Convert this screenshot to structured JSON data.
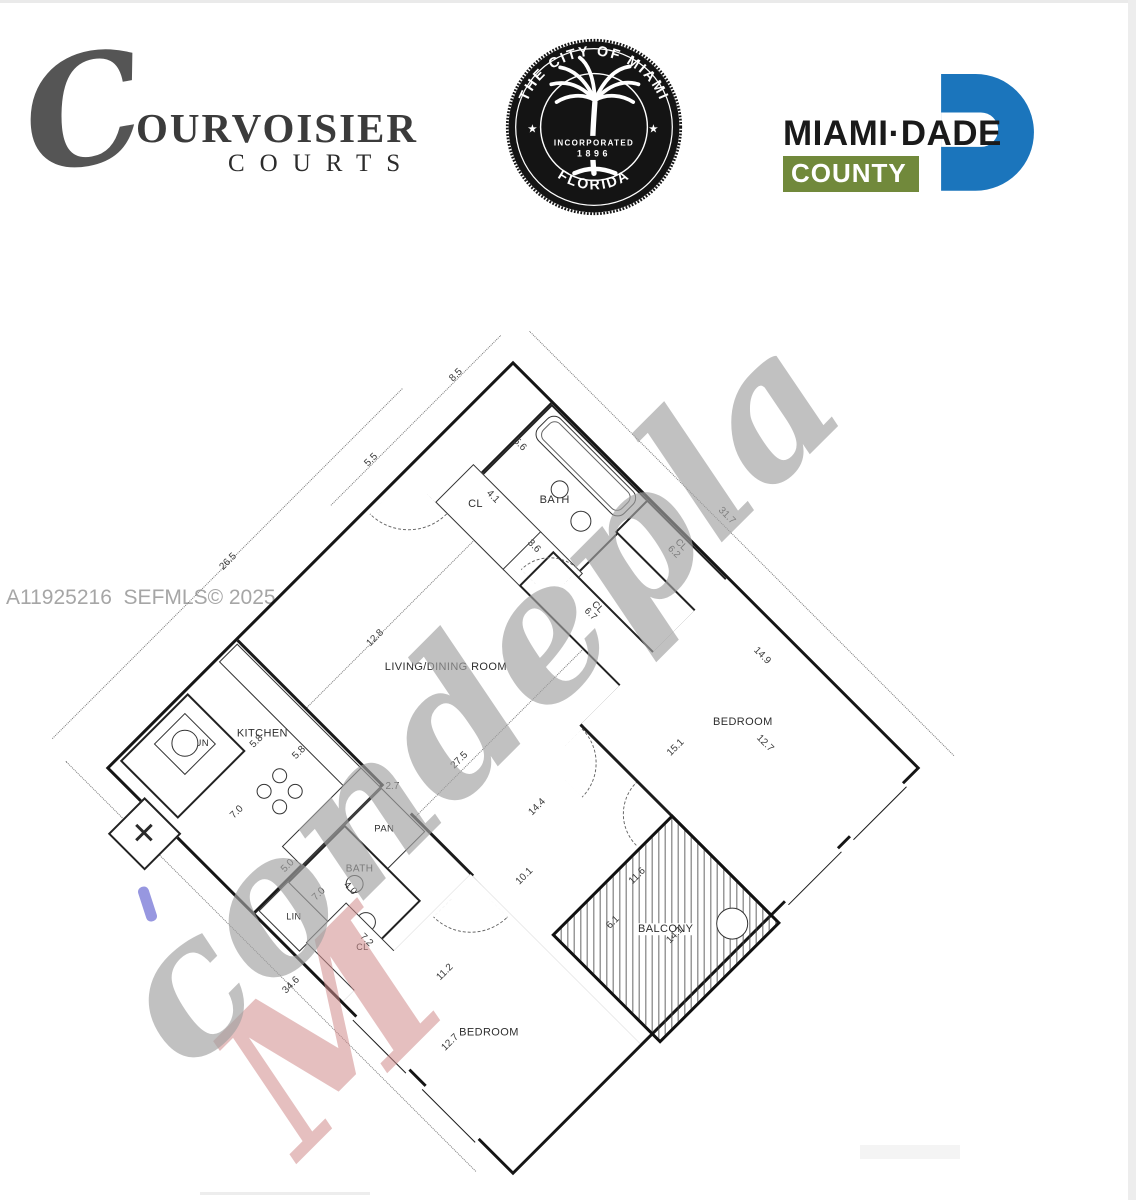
{
  "header": {
    "courvoisier": {
      "initial": "C",
      "name": "OURVOISIER",
      "sub": "COURTS"
    },
    "seal": {
      "arc_top": "THE CITY OF MIAMI",
      "arc_bottom": "FLORIDA",
      "inc1": "INCORPORATED",
      "inc2": "1896",
      "star": "★"
    },
    "dade": {
      "name": "MIAMI·DADE",
      "county": "COUNTY",
      "blue": "#1b75bc",
      "green": "#71893b"
    }
  },
  "watermark": {
    "mls": "A11925216  SEFMLS© 2025",
    "script": "condepla",
    "accent": "M",
    "script_color": "#a2a2a2",
    "accent_color": "#d08c8c"
  },
  "floorplan": {
    "shaft_mark": "✕",
    "rooms": {
      "bath1": "BATH",
      "cl_entry": "CL",
      "cl62": "CL",
      "cl67": "CL",
      "bedroom1": "BEDROOM",
      "living": "LIVING/DINING ROOM",
      "kitchen": "KITCHEN",
      "laun": "LAUN",
      "pan": "PAN",
      "bath2": "BATH",
      "lin": "LIN",
      "cl72": "CL",
      "bedroom2": "BEDROOM",
      "balcony": "BALCONY"
    },
    "dims": {
      "d85": "8.5",
      "d55": "5.5",
      "d265": "26.5",
      "d317": "31.7",
      "d346": "34.6",
      "d128": "12.8",
      "d275": "27.5",
      "d144": "14.4",
      "d101": "10.1",
      "d27": "2.7",
      "d56": "5.6",
      "d41": "4.1",
      "d36": "3.6",
      "d62": "6.2",
      "d67": "6.7",
      "d149": "14.9",
      "d151": "15.1",
      "d127r": "12.7",
      "d58a": "5.8",
      "d58b": "5.8",
      "d70k": "7.0",
      "d50": "5.0",
      "d70b": "7.0",
      "d40": "4.0",
      "d72": "7.2",
      "d112": "11.2",
      "d127b": "12.7",
      "d116": "11.6",
      "d61": "6.1",
      "d141": "14.1"
    }
  }
}
